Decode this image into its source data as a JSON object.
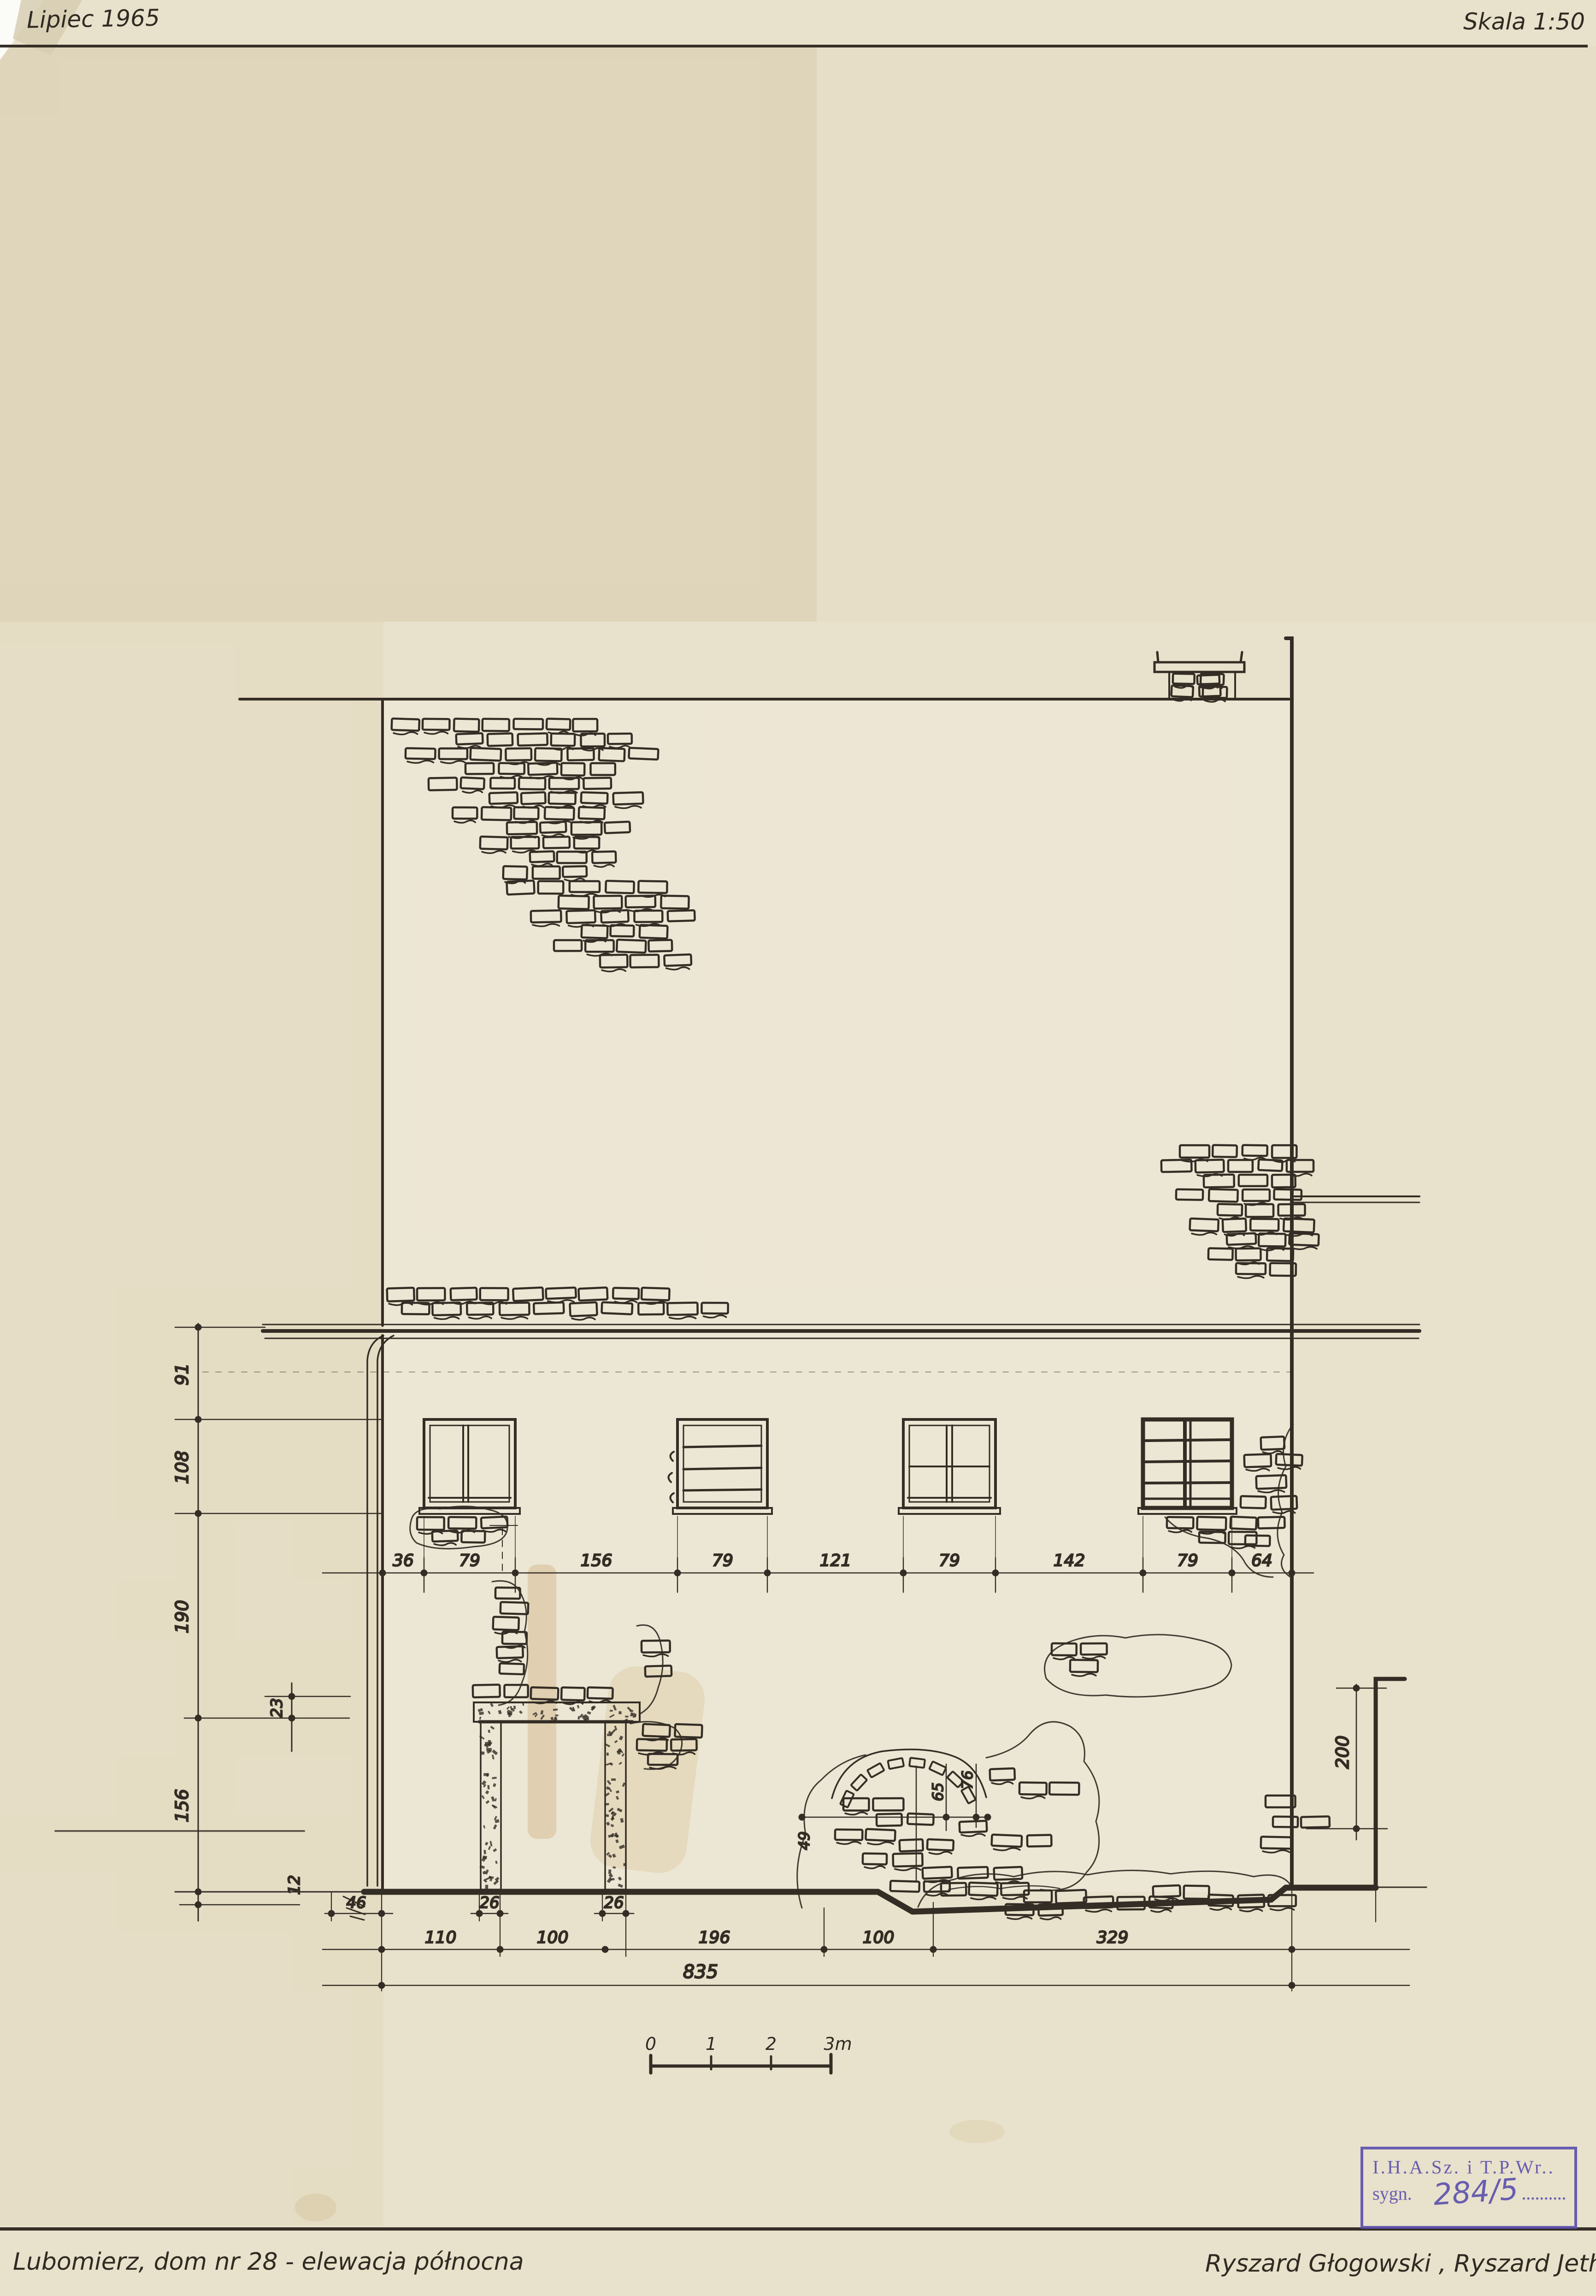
{
  "header": {
    "date": "Lipiec 1965",
    "scale": "Skala 1:50"
  },
  "footer": {
    "caption": "Lubomierz, dom nr 28 - elewacja północna",
    "authors": "Ryszard Głogowski , Ryszard Jethon"
  },
  "stamp": {
    "line1": "I.H.A.Sz. i T.P.Wr..",
    "sygn_label": "sygn.",
    "sygn_value": "284/5"
  },
  "dims": {
    "left_chain": [
      "91",
      "108",
      "190",
      "156",
      "12"
    ],
    "left_offset": "23",
    "window_row": [
      "36",
      "79",
      "156",
      "79",
      "121",
      "79",
      "142",
      "79",
      "64"
    ],
    "plinth_row": [
      "46",
      "26",
      "26"
    ],
    "bottom_row": [
      "110",
      "100",
      "196",
      "100",
      "329"
    ],
    "total": "835",
    "right_wall": "200",
    "niche": [
      "49",
      "65",
      "76"
    ]
  },
  "scalebar": {
    "labels": [
      "0",
      "1",
      "2",
      "3m"
    ]
  },
  "colors": {
    "ink": "#332d25",
    "paper": "#e8e1cb",
    "stamp": "#5b4fae"
  }
}
